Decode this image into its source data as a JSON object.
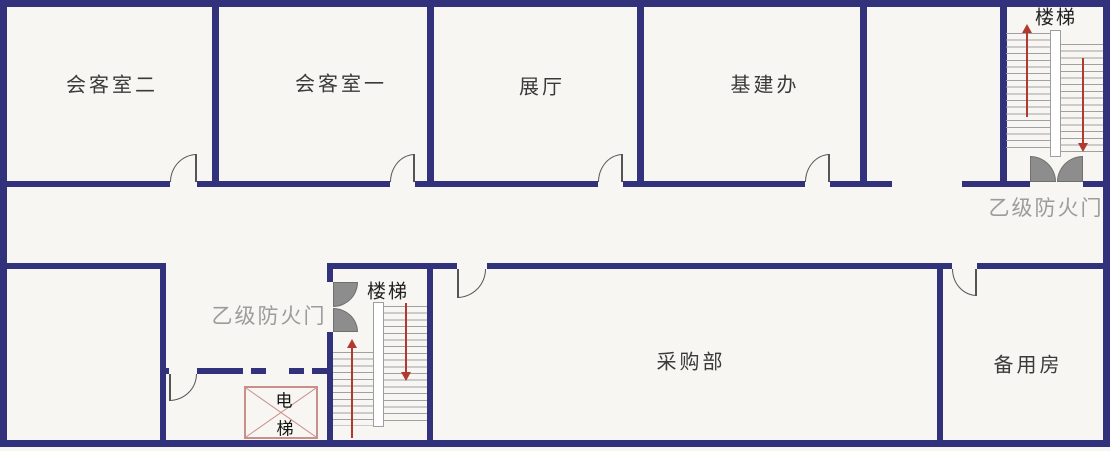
{
  "rooms": {
    "reception_2": "会客室二",
    "reception_1": "会客室一",
    "exhibition_hall": "展厅",
    "infrastructure_office": "基建办",
    "procurement_dept": "采购部",
    "spare_room": "备用房"
  },
  "stairs": {
    "top_right_label": "楼梯",
    "bottom_label": "楼梯"
  },
  "fire_doors": {
    "top_right_label": "乙级防火门",
    "lobby_label": "乙级防火门"
  },
  "elevator": {
    "line1": "电",
    "line2": "梯"
  },
  "colors": {
    "wall": "#31317c",
    "background": "#f7f6f2",
    "fire_door_gray": "#8d8d8d",
    "annotation_gray": "#9c9c9c",
    "arrow_red": "#b2392f",
    "elevator_outline": "#c9908a",
    "stair_tread": "#a0a0a0",
    "door_line": "#555555",
    "label_text": "#3a3a3a"
  }
}
